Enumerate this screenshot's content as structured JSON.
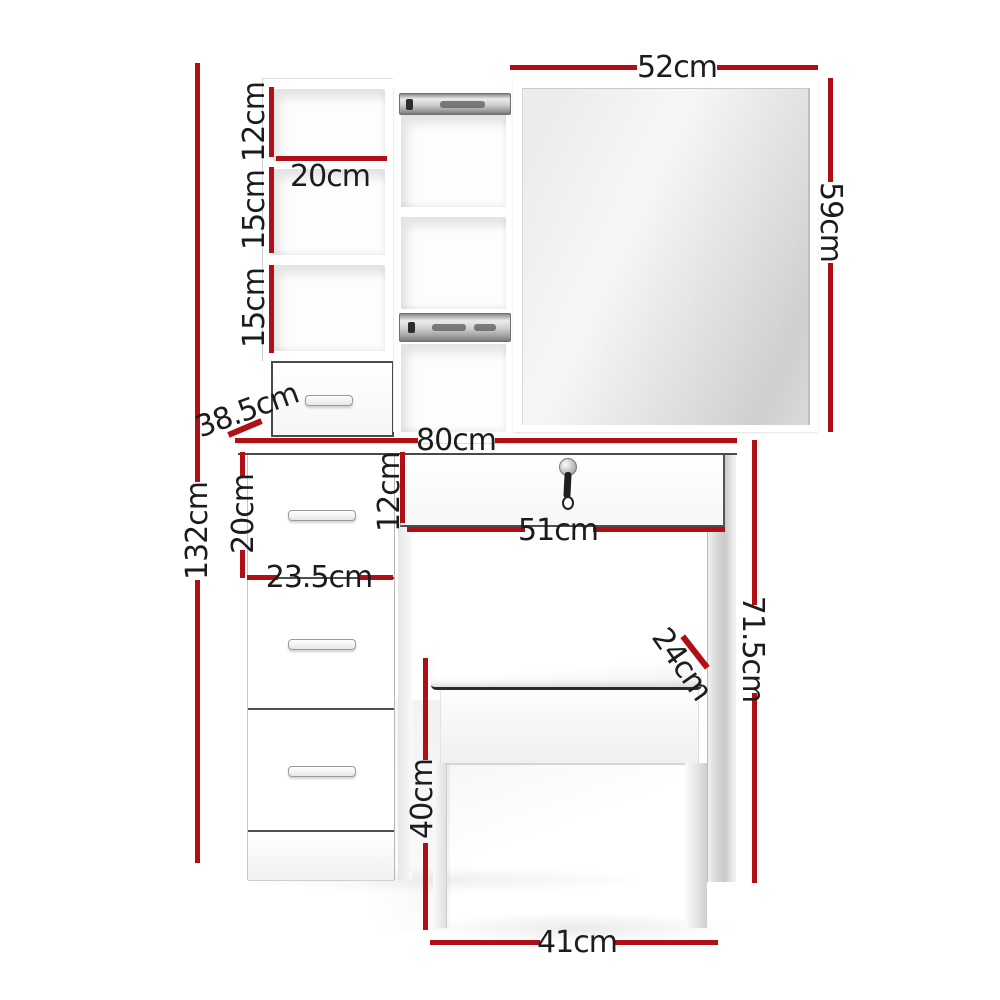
{
  "title": "Dressing table with mirror and stool - dimension diagram",
  "colors": {
    "dimension_line": "#b01015",
    "label_text": "#1c1c1c",
    "background": "#ffffff"
  },
  "dimensions": {
    "mirror_width": "52cm",
    "mirror_height": "59cm",
    "cubby_top_height": "12cm",
    "cubby_width": "20cm",
    "cubby_mid_height": "15cm",
    "cubby_bottom_height": "15cm",
    "depth": "38.5cm",
    "table_width": "80cm",
    "total_height": "132cm",
    "side_drawer_height": "20cm",
    "pedestal_width": "23.5cm",
    "center_drawer_height": "12cm",
    "center_drawer_width": "51cm",
    "table_height": "71.5cm",
    "stool_depth": "24cm",
    "stool_height": "40cm",
    "stool_width": "41cm"
  }
}
